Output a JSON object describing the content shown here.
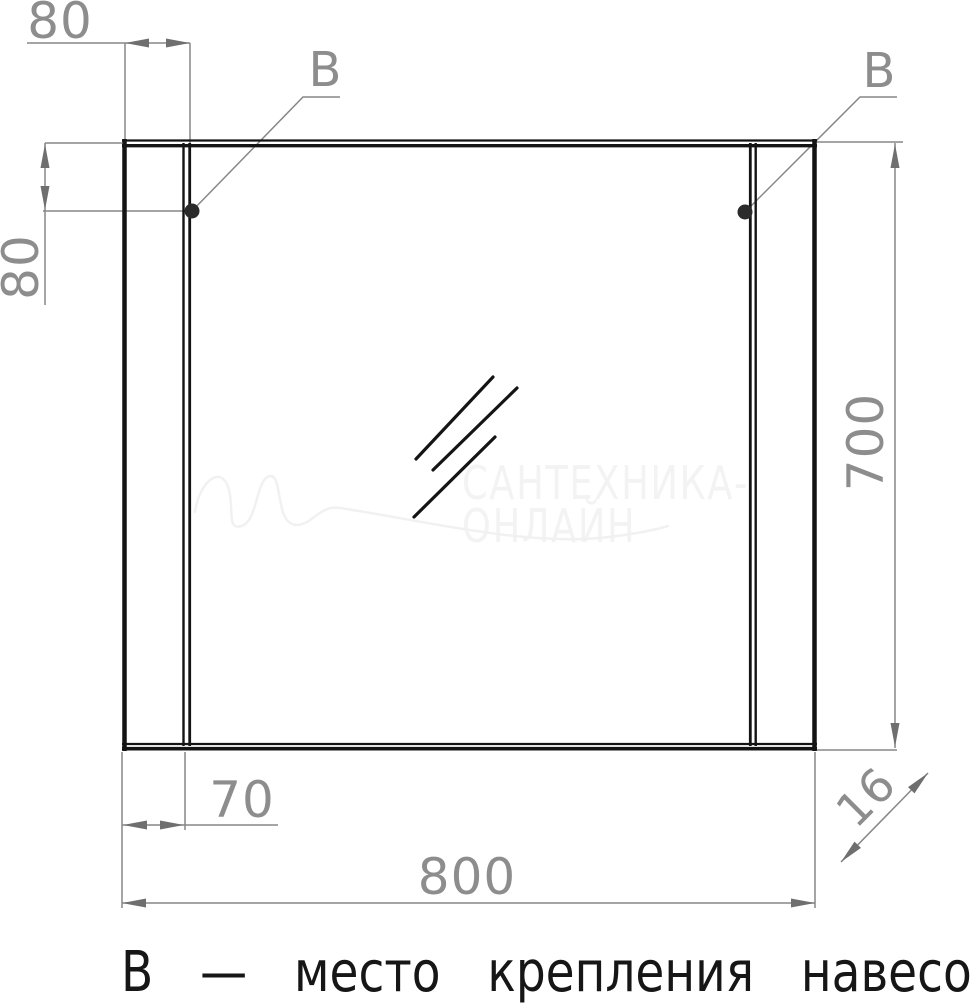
{
  "diagram": {
    "caption": "В — место крепления навесов",
    "watermark": {
      "line1": "САНТЕХНИКА-",
      "line2": "ОНЛАЙН"
    },
    "dims": {
      "top_offset": "80",
      "side_offset": "80",
      "height": "700",
      "panel_width": "70",
      "width": "800",
      "depth": "16"
    },
    "callouts": {
      "left": "В",
      "right": "В"
    },
    "colors": {
      "outline": "#141414",
      "dimension_line": "#878787",
      "dimension_text": "#8d8d8d",
      "watermark": "#f3f3f3"
    }
  }
}
